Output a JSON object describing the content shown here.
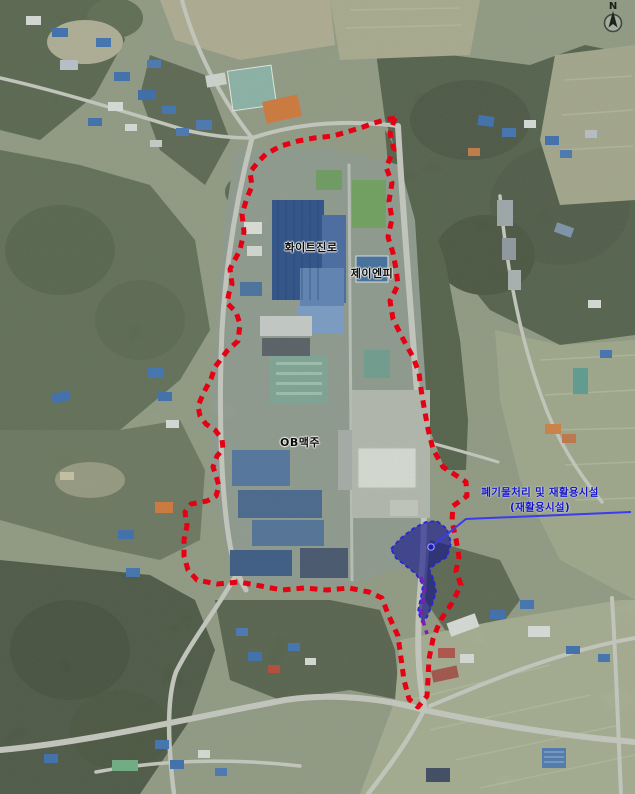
{
  "page": {
    "width": 635,
    "height": 794,
    "kind": "satellite-site-map"
  },
  "compass": {
    "label": "N"
  },
  "overlay": {
    "colors": {
      "site_boundary": "#e60014",
      "purple_line": "#7a1fb4",
      "facility_fill": "#14148c",
      "facility_border": "#2626d8",
      "facility_label": "#1414cc",
      "leader_line": "#3b3bf0",
      "label_text": "#0b0b0b"
    },
    "site_boundary": {
      "style": "dashed",
      "points": [
        [
          395,
          118
        ],
        [
          390,
          133
        ],
        [
          394,
          150
        ],
        [
          386,
          167
        ],
        [
          392,
          183
        ],
        [
          389,
          201
        ],
        [
          392,
          219
        ],
        [
          388,
          237
        ],
        [
          393,
          253
        ],
        [
          396,
          269
        ],
        [
          398,
          285
        ],
        [
          390,
          301
        ],
        [
          393,
          319
        ],
        [
          403,
          339
        ],
        [
          413,
          357
        ],
        [
          419,
          373
        ],
        [
          421,
          389
        ],
        [
          424,
          407
        ],
        [
          428,
          429
        ],
        [
          433,
          449
        ],
        [
          443,
          467
        ],
        [
          457,
          476
        ],
        [
          466,
          482
        ],
        [
          467,
          496
        ],
        [
          453,
          506
        ],
        [
          452,
          521
        ],
        [
          456,
          539
        ],
        [
          459,
          557
        ],
        [
          456,
          571
        ],
        [
          461,
          585
        ],
        [
          452,
          603
        ],
        [
          440,
          621
        ],
        [
          433,
          639
        ],
        [
          429,
          659
        ],
        [
          428,
          679
        ],
        [
          427,
          696
        ],
        [
          418,
          707
        ],
        [
          409,
          699
        ],
        [
          404,
          680
        ],
        [
          401,
          658
        ],
        [
          398,
          636
        ],
        [
          388,
          614
        ],
        [
          382,
          598
        ],
        [
          369,
          592
        ],
        [
          349,
          588
        ],
        [
          327,
          590
        ],
        [
          304,
          588
        ],
        [
          282,
          590
        ],
        [
          261,
          586
        ],
        [
          239,
          582
        ],
        [
          217,
          584
        ],
        [
          197,
          580
        ],
        [
          188,
          570
        ],
        [
          184,
          556
        ],
        [
          184,
          540
        ],
        [
          187,
          526
        ],
        [
          185,
          512
        ],
        [
          191,
          504
        ],
        [
          207,
          501
        ],
        [
          216,
          496
        ],
        [
          219,
          486
        ],
        [
          216,
          476
        ],
        [
          213,
          467
        ],
        [
          217,
          456
        ],
        [
          223,
          449
        ],
        [
          222,
          439
        ],
        [
          215,
          430
        ],
        [
          206,
          424
        ],
        [
          200,
          416
        ],
        [
          198,
          406
        ],
        [
          204,
          392
        ],
        [
          211,
          379
        ],
        [
          215,
          367
        ],
        [
          227,
          351
        ],
        [
          238,
          341
        ],
        [
          240,
          324
        ],
        [
          236,
          312
        ],
        [
          227,
          303
        ],
        [
          229,
          293
        ],
        [
          232,
          284
        ],
        [
          230,
          269
        ],
        [
          240,
          250
        ],
        [
          244,
          232
        ],
        [
          242,
          214
        ],
        [
          247,
          198
        ],
        [
          252,
          186
        ],
        [
          250,
          172
        ],
        [
          259,
          161
        ],
        [
          266,
          154
        ],
        [
          281,
          146
        ],
        [
          298,
          141
        ],
        [
          314,
          138
        ],
        [
          333,
          136
        ],
        [
          350,
          131
        ],
        [
          363,
          127
        ],
        [
          374,
          123
        ],
        [
          385,
          120
        ],
        [
          395,
          118
        ]
      ]
    },
    "purple_segment": {
      "style": "dashed",
      "points": [
        [
          421,
          577
        ],
        [
          425,
          589
        ],
        [
          423,
          601
        ],
        [
          421,
          613
        ],
        [
          424,
          624
        ],
        [
          427,
          634
        ]
      ]
    },
    "facility_area": {
      "marker": [
        431,
        547
      ],
      "points": [
        [
          391,
          549
        ],
        [
          401,
          538
        ],
        [
          414,
          528
        ],
        [
          426,
          522
        ],
        [
          437,
          521
        ],
        [
          447,
          529
        ],
        [
          451,
          543
        ],
        [
          447,
          557
        ],
        [
          437,
          563
        ],
        [
          429,
          569
        ],
        [
          434,
          580
        ],
        [
          436,
          592
        ],
        [
          432,
          605
        ],
        [
          427,
          617
        ],
        [
          422,
          622
        ],
        [
          418,
          611
        ],
        [
          421,
          597
        ],
        [
          423,
          585
        ],
        [
          416,
          574
        ],
        [
          406,
          566
        ],
        [
          396,
          558
        ]
      ]
    },
    "leader_line": {
      "points": [
        [
          431,
          547
        ],
        [
          466,
          519
        ],
        [
          631,
          512
        ]
      ]
    },
    "labels": [
      {
        "id": "company-1",
        "text": "화이트진로",
        "x": 311,
        "y": 247
      },
      {
        "id": "company-2",
        "text": "제이엔피",
        "x": 372,
        "y": 273
      },
      {
        "id": "company-3",
        "text": "OB맥주",
        "x": 300,
        "y": 442
      },
      {
        "id": "facility",
        "lines": [
          "폐기물처리 및 재활용시설",
          "(재활용시설)"
        ],
        "x": 540,
        "y": 500
      }
    ]
  }
}
